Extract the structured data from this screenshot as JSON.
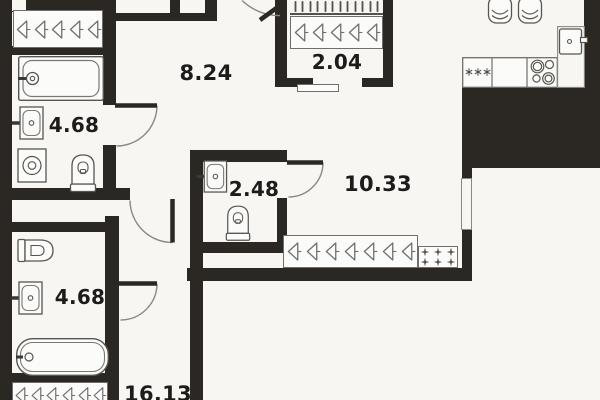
{
  "rooms": {
    "hallway": {
      "area": "8.24"
    },
    "closet": {
      "area": "2.04"
    },
    "bathroom_top": {
      "area": "4.68"
    },
    "wc": {
      "area": "2.48"
    },
    "kitchen_living": {
      "area": "10.33"
    },
    "bathroom_bottom": {
      "area": "4.68"
    },
    "room_bottom": {
      "area": "16.13"
    }
  },
  "counts": {
    "top_closet_hangers": 5,
    "closet_rail_ticks": 12,
    "closet_hangers": 5,
    "living_wardrobe_hangers": 7,
    "shelf_plus_marks": 6,
    "bottom_wardrobe_hangers": 6,
    "freezer_asterisks": 3
  },
  "icons": [
    "hanger-icon",
    "rail-tick-icon",
    "plus-mark-icon",
    "freezer-asterisk-icon",
    "bathtub-icon",
    "sink-icon",
    "toilet-icon",
    "washing-machine-icon",
    "fridge-icon",
    "stove-icon",
    "chair-icon",
    "door-arc",
    "window",
    "sliding-door"
  ],
  "colors": {
    "wall": "#2b2823",
    "bg": "#f7f6f3",
    "text": "#1d1c1a",
    "line": "#6f6e6c"
  }
}
